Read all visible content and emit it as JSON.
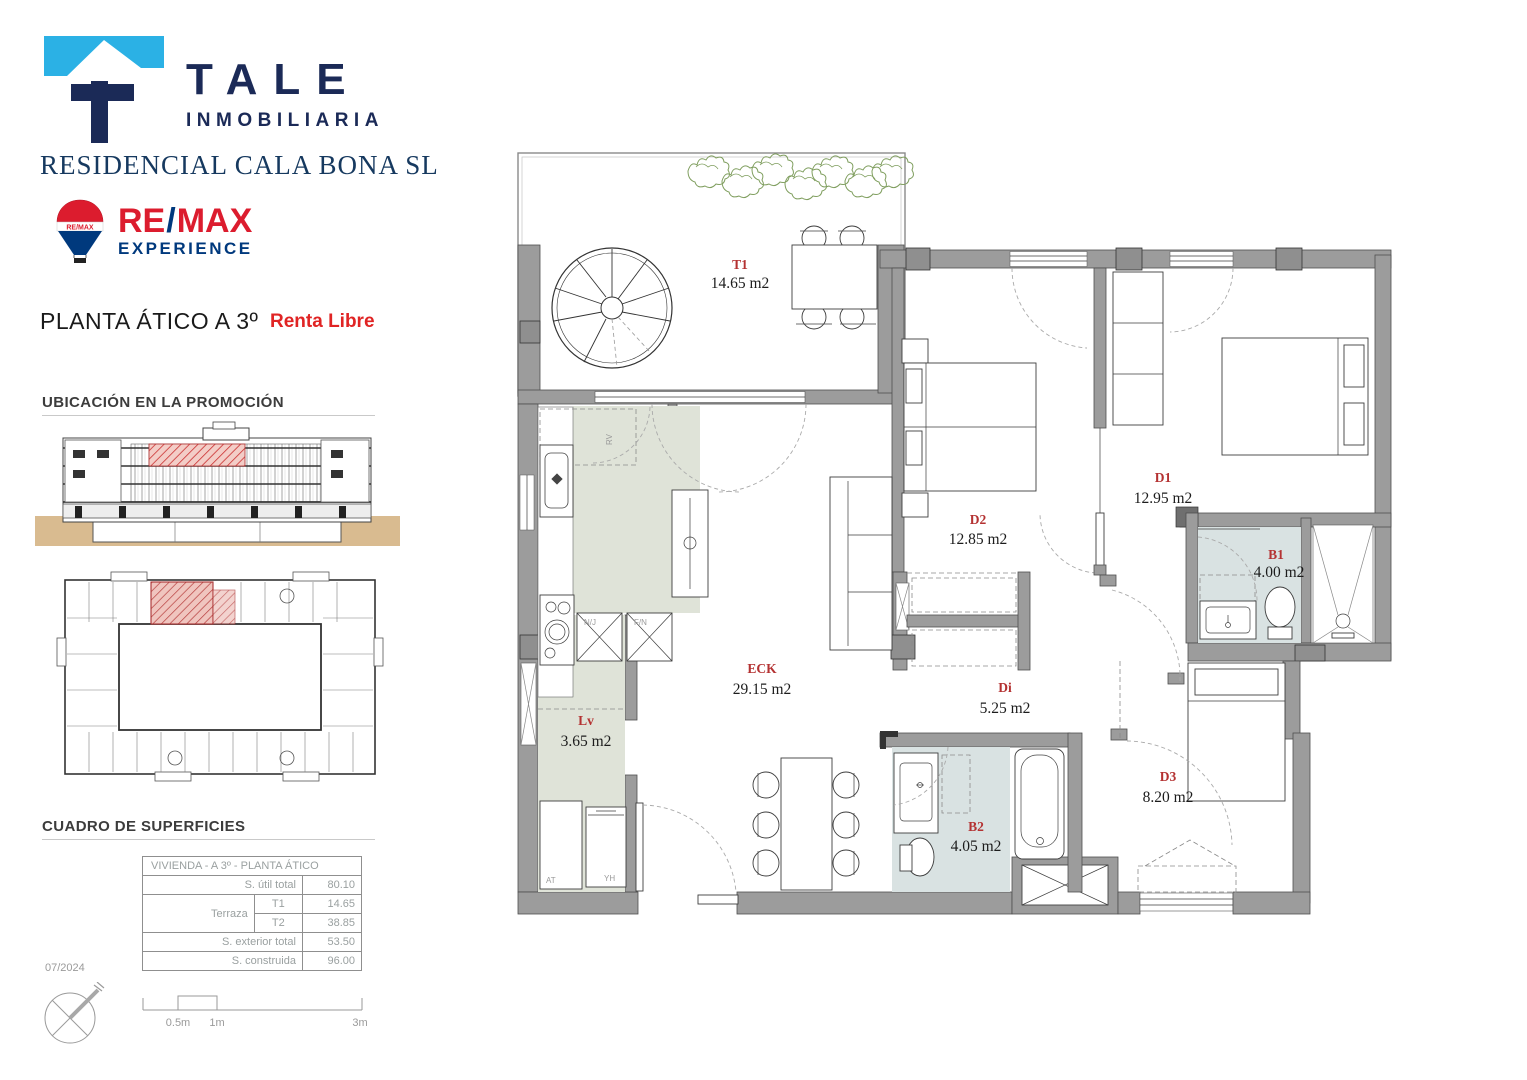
{
  "brand": {
    "name": "TALE",
    "subtitle": "INMOBILIARIA",
    "company": "RESIDENCIAL CALA BONA SL"
  },
  "remax": {
    "name_left": "RE",
    "slash": "/",
    "name_right": "MAX",
    "sub": "EXPERIENCE",
    "balloon_text": "RE/MAX"
  },
  "header": {
    "title": "PLANTA ÁTICO A 3º",
    "tag": "Renta Libre"
  },
  "sections": {
    "location": "UBICACIÓN EN LA PROMOCIÓN",
    "surfaces": "CUADRO DE SUPERFICIES"
  },
  "table": {
    "title": "VIVIENDA - A 3º - PLANTA ÁTICO",
    "rows": [
      {
        "label": "S. útil total",
        "sub": "",
        "value": "80.10"
      },
      {
        "label": "Terraza",
        "sub": "T1",
        "value": "14.65"
      },
      {
        "label": "",
        "sub": "T2",
        "value": "38.85"
      },
      {
        "label": "S. exterior total",
        "sub": "",
        "value": "53.50"
      },
      {
        "label": "S. construida",
        "sub": "",
        "value": "96.00"
      }
    ]
  },
  "plan": {
    "rooms": [
      {
        "code": "T1",
        "area": "14.65 m2"
      },
      {
        "code": "D2",
        "area": "12.85 m2"
      },
      {
        "code": "D1",
        "area": "12.95 m2"
      },
      {
        "code": "B1",
        "area": "4.00 m2"
      },
      {
        "code": "ECK",
        "area": "29.15 m2"
      },
      {
        "code": "Di",
        "area": "5.25 m2"
      },
      {
        "code": "Lv",
        "area": "3.65 m2"
      },
      {
        "code": "B2",
        "area": "4.05 m2"
      },
      {
        "code": "D3",
        "area": "8.20 m2"
      }
    ],
    "appliances": [
      "AT",
      "YH"
    ],
    "shafts": [
      "N/J",
      "F/N"
    ],
    "cabinet": "RV"
  },
  "footer": {
    "date": "07/2024",
    "scale": [
      "0.5m",
      "1m",
      "3m"
    ]
  },
  "colors": {
    "brand_navy": "#1b2a57",
    "brand_blue": "#2bb1e5",
    "remax_red": "#dc1c2e",
    "remax_blue": "#00397d",
    "accent_red": "#e02424",
    "wall_gray": "#9c9c9c",
    "kitchen_fill": "#dfe3d8",
    "bath_fill": "#d9e2e2",
    "ground_tan": "#d9bb90"
  }
}
